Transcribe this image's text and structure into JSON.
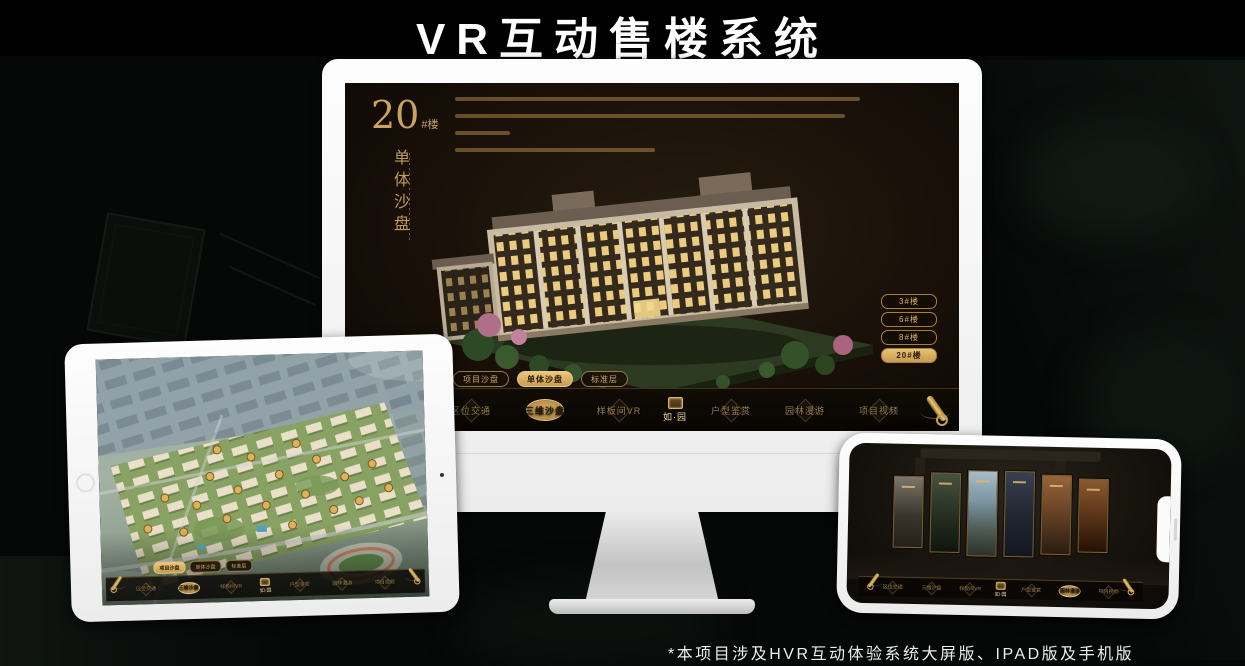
{
  "page": {
    "title": "VR互动售楼系统",
    "footer_note": "*本项目涉及HVR互动体验系统大屏版、IPAD版及手机版"
  },
  "colors": {
    "accent_gold": "#cfa55e",
    "active_gold": "#d9b25f",
    "screen_background": "#1c140c",
    "page_background": "#060807"
  },
  "brand": {
    "logo_text": "如·园"
  },
  "monitor": {
    "heading_number": "20",
    "heading_suffix": "#楼",
    "heading_caption": "单体沙盘",
    "floor_buttons": [
      {
        "label": "3#楼"
      },
      {
        "label": "6#楼"
      },
      {
        "label": "8#楼"
      },
      {
        "label": "20#楼"
      }
    ],
    "active_floor": "20#楼",
    "tabs": [
      {
        "label": "项目沙盘"
      },
      {
        "label": "单体沙盘"
      },
      {
        "label": "标准层"
      }
    ],
    "active_tab": "单体沙盘",
    "menu": [
      {
        "label": "区位交通"
      },
      {
        "label": "三维沙盘"
      },
      {
        "label": "样板间VR"
      },
      {
        "label": "户型鉴赏"
      },
      {
        "label": "园林漫游"
      },
      {
        "label": "项目视频"
      }
    ],
    "active_menu": "三维沙盘"
  },
  "tablet": {
    "tabs": [
      {
        "label": "项目沙盘"
      },
      {
        "label": "单体沙盘"
      },
      {
        "label": "标准层"
      }
    ],
    "active_tab": "项目沙盘",
    "menu": [
      {
        "label": "区位交通"
      },
      {
        "label": "三维沙盘"
      },
      {
        "label": "样板间VR"
      },
      {
        "label": "户型鉴赏"
      },
      {
        "label": "园林漫游"
      },
      {
        "label": "项目视频"
      }
    ],
    "active_menu": "三维沙盘"
  },
  "phone": {
    "menu": [
      {
        "label": "区位交通"
      },
      {
        "label": "三维沙盘"
      },
      {
        "label": "样板间VR"
      },
      {
        "label": "户型鉴赏"
      },
      {
        "label": "园林漫游"
      },
      {
        "label": "项目视频"
      }
    ],
    "active_menu": "园林漫游"
  }
}
